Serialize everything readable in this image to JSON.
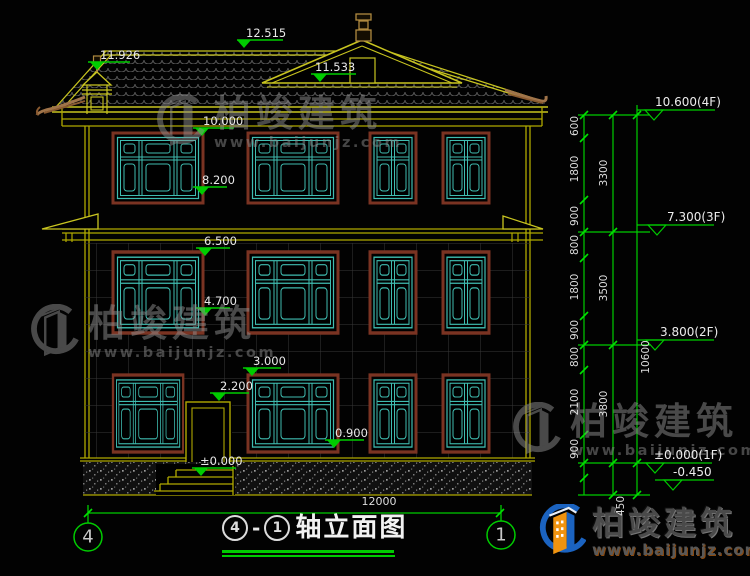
{
  "drawing": {
    "levels": {
      "ridge": "12.515",
      "left_finial": "11.926",
      "gable": "11.533",
      "eave": "10.000",
      "sill_3f": "8.200",
      "band_2f": "6.500",
      "sill_2f": "4.700",
      "window_top_1f": "3.000",
      "door_top": "2.200",
      "sill_1f": "0.900",
      "ground": "±0.000"
    },
    "floor_levels": {
      "f4": "10.600(4F)",
      "f3": "7.300(3F)",
      "f2": "3.800(2F)",
      "f1": "±0.000(1F)",
      "below_grade": "-0.450"
    },
    "dims": {
      "segments": [
        "600",
        "1800",
        "900",
        "800",
        "1800",
        "900",
        "800",
        "2100",
        "900"
      ],
      "floors": [
        "3300",
        "3500",
        "3800"
      ],
      "total": "10600",
      "foundation": "450",
      "width": "12000"
    },
    "axes": {
      "left": "4",
      "right": "1"
    },
    "title": {
      "start": "4",
      "dash": "-",
      "end": "1",
      "text": "轴立面图"
    }
  },
  "watermark": {
    "brand": "柏竣建筑",
    "site": "www.baijunjz.com"
  },
  "logo": {
    "brand": "柏竣建筑",
    "site": "www.baijunjz.com"
  },
  "colors": {
    "dimension": "#00cc00",
    "wall_outline": "#b0a800",
    "roof_outline": "#c8c420",
    "window": "#3fbcb0",
    "window_trim": "#7a3322",
    "text": "#e8e8e8"
  }
}
